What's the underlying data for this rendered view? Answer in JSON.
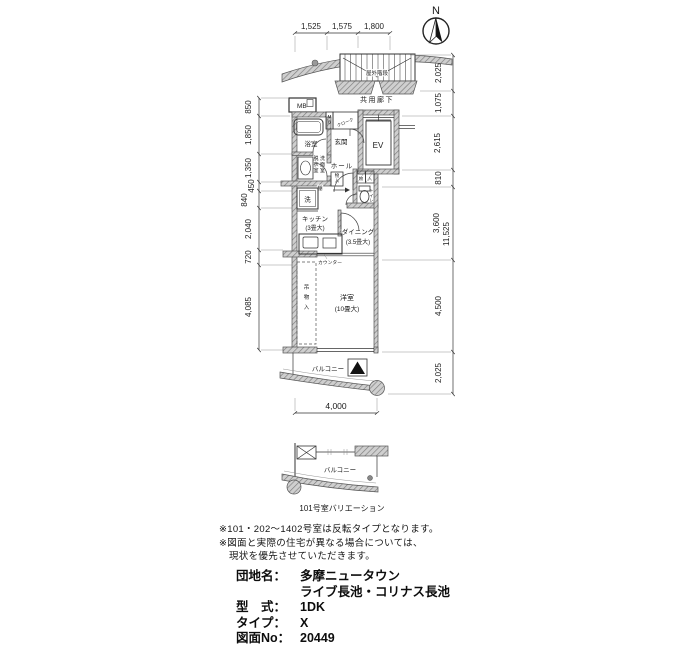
{
  "compass": {
    "label": "N"
  },
  "dimensions": {
    "top": [
      "1,525",
      "1,575",
      "1,800"
    ],
    "left": [
      "850",
      "1,850",
      "1,350",
      "450",
      "840",
      "2,040",
      "720",
      "4,085"
    ],
    "right": [
      "2,025",
      "1,075",
      "2,615",
      "810",
      "3,600",
      "4,500",
      "2,025"
    ],
    "right_overall": "11,525",
    "bottom": "4,000"
  },
  "plan_labels": {
    "outdoor_stairs": "屋外階段",
    "common_corridor": "共用廊下",
    "meter_box": "MB",
    "meter_box_small": "MB",
    "cloak": "クローク",
    "bathroom": "浴室",
    "entrance": "玄関",
    "elevator": "EV",
    "hall": "ホール",
    "washroom_col_left": "脱衣室",
    "washroom_col_right": "洗面室",
    "shelf": "棚",
    "storage": "物入",
    "storage_char1": "物",
    "storage_char2": "入",
    "washer": "洗",
    "toilet": "トイレ",
    "kitchen": "キッチン",
    "kitchen_size": "(3畳大)",
    "dining": "ダイニング",
    "dining_size": "(3.5畳大)",
    "counter": "カウンター",
    "hanging_closet": "吊物入",
    "western_room": "洋室",
    "western_room_size": "(10畳大)",
    "balcony": "バルコニー"
  },
  "variation": {
    "balcony": "バルコニー",
    "caption": "101号室バリエーション"
  },
  "notes": [
    "※101・202〜1402号室は反転タイプとなります。",
    "※図面と実際の住宅が異なる場合については、",
    "現状を優先させていただきます。"
  ],
  "info": {
    "lines": [
      {
        "label": "団地名：",
        "value": "多摩ニュータウン"
      },
      {
        "label": "",
        "value": "ライブ長池・コリナス長池"
      },
      {
        "label": "型　式：",
        "value": "1DK"
      },
      {
        "label": "タイプ：",
        "value": "X"
      },
      {
        "label": "図面No：",
        "value": "20449"
      }
    ]
  }
}
